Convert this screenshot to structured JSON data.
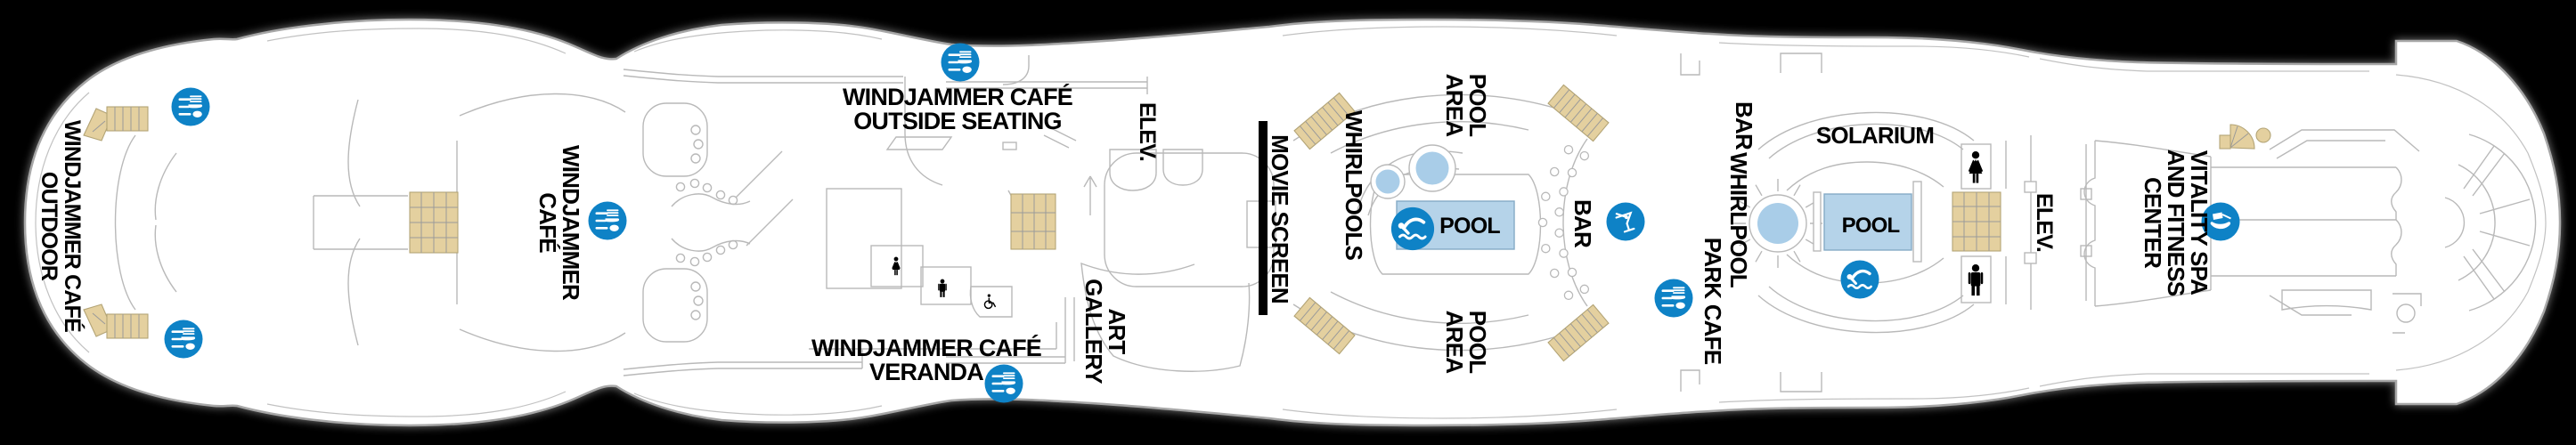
{
  "deck_plan": {
    "colors": {
      "background": "#000000",
      "hull_fill": "#ffffff",
      "hull_outline": "#a7a7a7",
      "interior_line": "#b9b9b9",
      "stairs": "#e4d09f",
      "marker_blue": "#0e82c6",
      "water": "#b5d3e9",
      "label_text": "#000000"
    },
    "icons": {
      "dining": "fork-knife-spoon marker",
      "pool": "swimmer marker",
      "bar": "martini-glass marker",
      "spa": "massage marker",
      "restroom_women": "woman silhouette",
      "restroom_men": "man silhouette",
      "accessible_restroom": "wheelchair symbol",
      "stairs": "tan stair blocks",
      "movie_screen": "black screen bar"
    },
    "venues": {
      "windjammer_outdoor": {
        "label_lines": [
          "WINDJAMMER CAFÉ",
          "OUTDOOR"
        ]
      },
      "windjammer_cafe": {
        "label_lines": [
          "WINDJAMMER",
          "CAFÉ"
        ]
      },
      "windjammer_outside_seating": {
        "label_lines": [
          "WINDJAMMER CAFÉ",
          "OUTSIDE SEATING"
        ]
      },
      "windjammer_veranda": {
        "label_lines": [
          "WINDJAMMER CAFÉ",
          "VERANDA"
        ]
      },
      "elevators_mid": {
        "label": "ELEV."
      },
      "art_gallery": {
        "label_lines": [
          "ART",
          "GALLERY"
        ]
      },
      "movie_screen": {
        "label": "MOVIE SCREEN"
      },
      "whirlpools": {
        "label": "WHIRLPOOLS"
      },
      "pool_area_top": {
        "label_lines": [
          "POOL",
          "AREA"
        ]
      },
      "pool_area_bottom": {
        "label_lines": [
          "POOL",
          "AREA"
        ]
      },
      "main_pool": {
        "label": "POOL"
      },
      "pool_bar": {
        "label": "BAR"
      },
      "solarium_bar": {
        "label": "BAR"
      },
      "solarium_whirlpool": {
        "label": "WHIRLPOOL"
      },
      "park_cafe": {
        "label": "PARK CAFE"
      },
      "solarium": {
        "label": "SOLARIUM"
      },
      "solarium_pool": {
        "label": "POOL"
      },
      "elevators_forward": {
        "label": "ELEV."
      },
      "vitality_spa": {
        "label_lines": [
          "VITALITY SPA",
          "AND FITNESS",
          "CENTER"
        ]
      }
    }
  }
}
